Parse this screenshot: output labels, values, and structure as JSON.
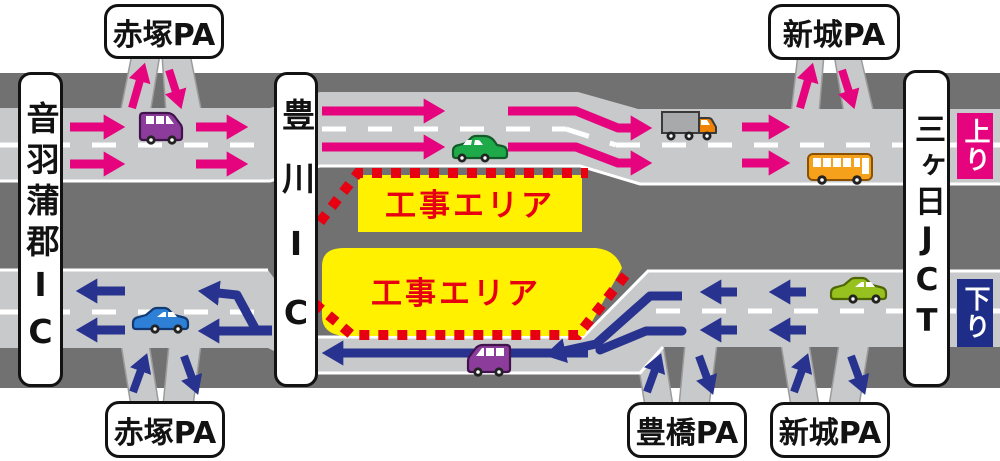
{
  "labels": {
    "ic_left": "音羽蒲郡IC",
    "ic_middle": "豊川IC",
    "jct_right": "三ヶ日JCT",
    "pa_top_left": "赤塚PA",
    "pa_top_right": "新城PA",
    "pa_bottom_left": "赤塚PA",
    "pa_bottom_center": "豊橋PA",
    "pa_bottom_right": "新城PA",
    "direction_up": "上り",
    "direction_down": "下り"
  },
  "construction": {
    "upper_label": "工事エリア",
    "lower_label": "工事エリア"
  },
  "colors": {
    "up_line_arrows": "#e5047e",
    "down_line_arrows": "#27338f",
    "roadway": "#c8c9ca",
    "shoulder_band": "#727171",
    "construction_zone_fill": "#fff100",
    "construction_text": "#e60012",
    "construction_border_dots": "#e60012",
    "up_badge_bg": "#e5047e",
    "down_badge_bg": "#1d2d88",
    "lane_marking": "#ffffff"
  },
  "icons": {
    "up_line_vehicles": [
      "van-icon",
      "car-icon",
      "truck-icon",
      "bus-icon"
    ],
    "down_line_vehicles": [
      "car-icon",
      "van-icon",
      "car-icon"
    ]
  }
}
